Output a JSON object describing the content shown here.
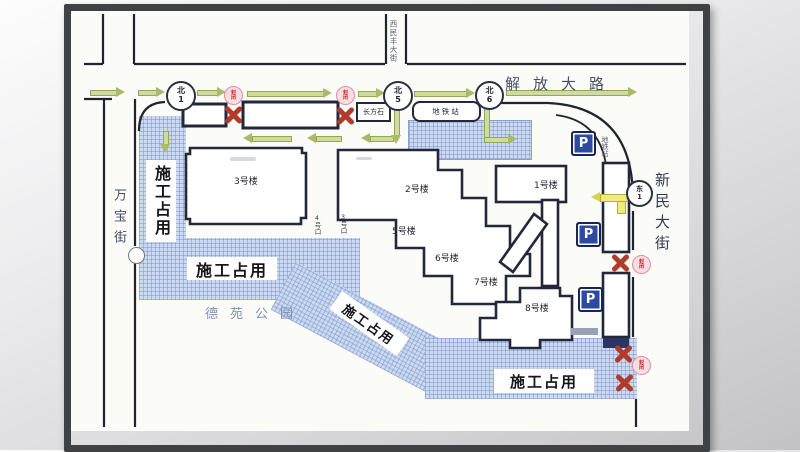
{
  "streets": {
    "jiefang": "解放大路",
    "xinmin": "新民大街",
    "wanbao": "万宝街",
    "ximinfeng": "西民丰大街"
  },
  "park": {
    "name": "德苑公园"
  },
  "buildings": {
    "b1": "1号楼",
    "b2": "2号楼",
    "b3": "3号楼",
    "b5": "5号楼",
    "b6": "6号楼",
    "b7": "7号楼",
    "b8": "8号楼"
  },
  "subway": {
    "station": "地铁站",
    "lane": "地铁站",
    "exit4": "4号口",
    "exit3": "3号口"
  },
  "landmark": {
    "name": "长方石"
  },
  "gates": {
    "n1": {
      "d": "北",
      "n": "1"
    },
    "n5": {
      "d": "北",
      "n": "5"
    },
    "n6": {
      "d": "北",
      "n": "6"
    },
    "e1": {
      "d": "东",
      "n": "1"
    }
  },
  "badge": {
    "c1": "封",
    "c2": "闭"
  },
  "construction": {
    "label": "施工占用"
  },
  "parking": {
    "p": "P"
  },
  "colors": {
    "hatch_blue": "#ccd9ef",
    "road_line": "#20242f",
    "closed_red": "#b23a28",
    "badge_pink": "#f9dde2",
    "arrow_green": "#cfdd9b",
    "arrow_yellow": "#f0ec77",
    "parking_blue": "#2d4aa1"
  }
}
